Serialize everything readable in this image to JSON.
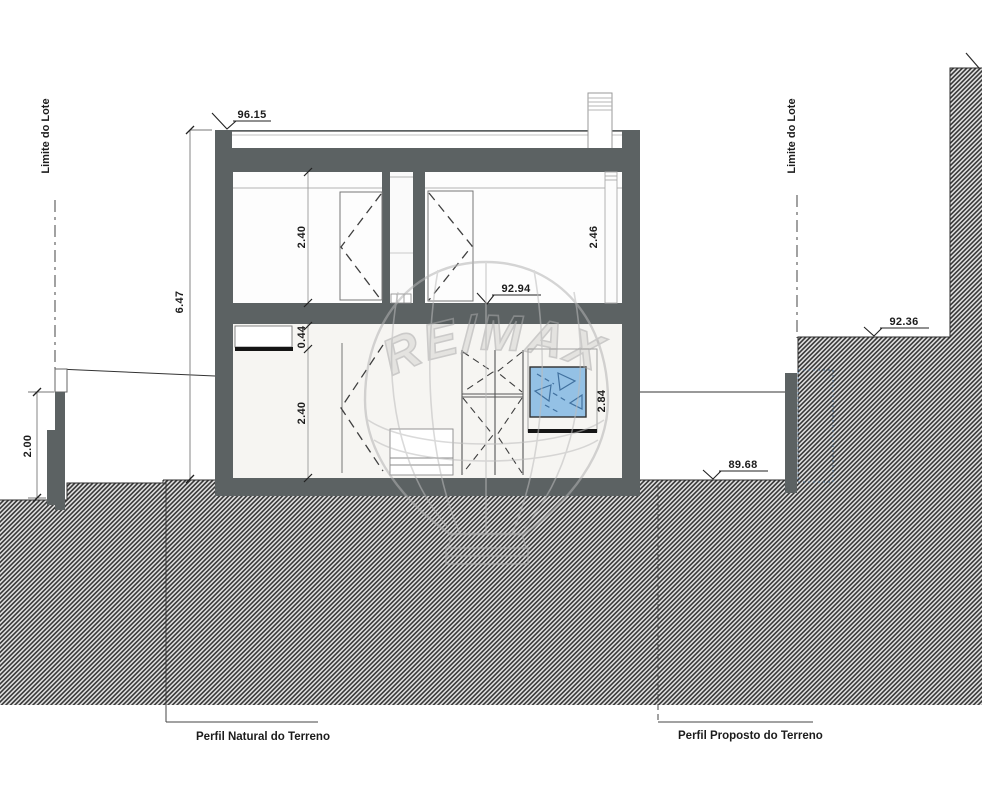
{
  "watermark": {
    "text": "RE/MAX"
  },
  "boundaries": {
    "left": "Limite do Lote",
    "right": "Limite do Lote"
  },
  "terrain_labels": {
    "natural": "Perfil Natural do Terreno",
    "proposed": "Perfil Proposto do Terreno"
  },
  "elevations": {
    "roof_top": "96.15",
    "upper_floor": "92.94",
    "terrain_right_upper": "92.36",
    "terrain_right_lower": "89.68"
  },
  "dimensions": {
    "total_height": "6.47",
    "upper_left_room_height": "2.40",
    "upper_right_room_height": "2.46",
    "beam_drop": "0.44",
    "ground_floor_room_height": "2.40",
    "window_opening_height": "2.84",
    "retaining_wall_height": "2.00"
  },
  "colors": {
    "structure": "#5c6263",
    "glass": "#94c1e5",
    "hatch_line": "#383838",
    "watermark": "#b3b3b3"
  }
}
